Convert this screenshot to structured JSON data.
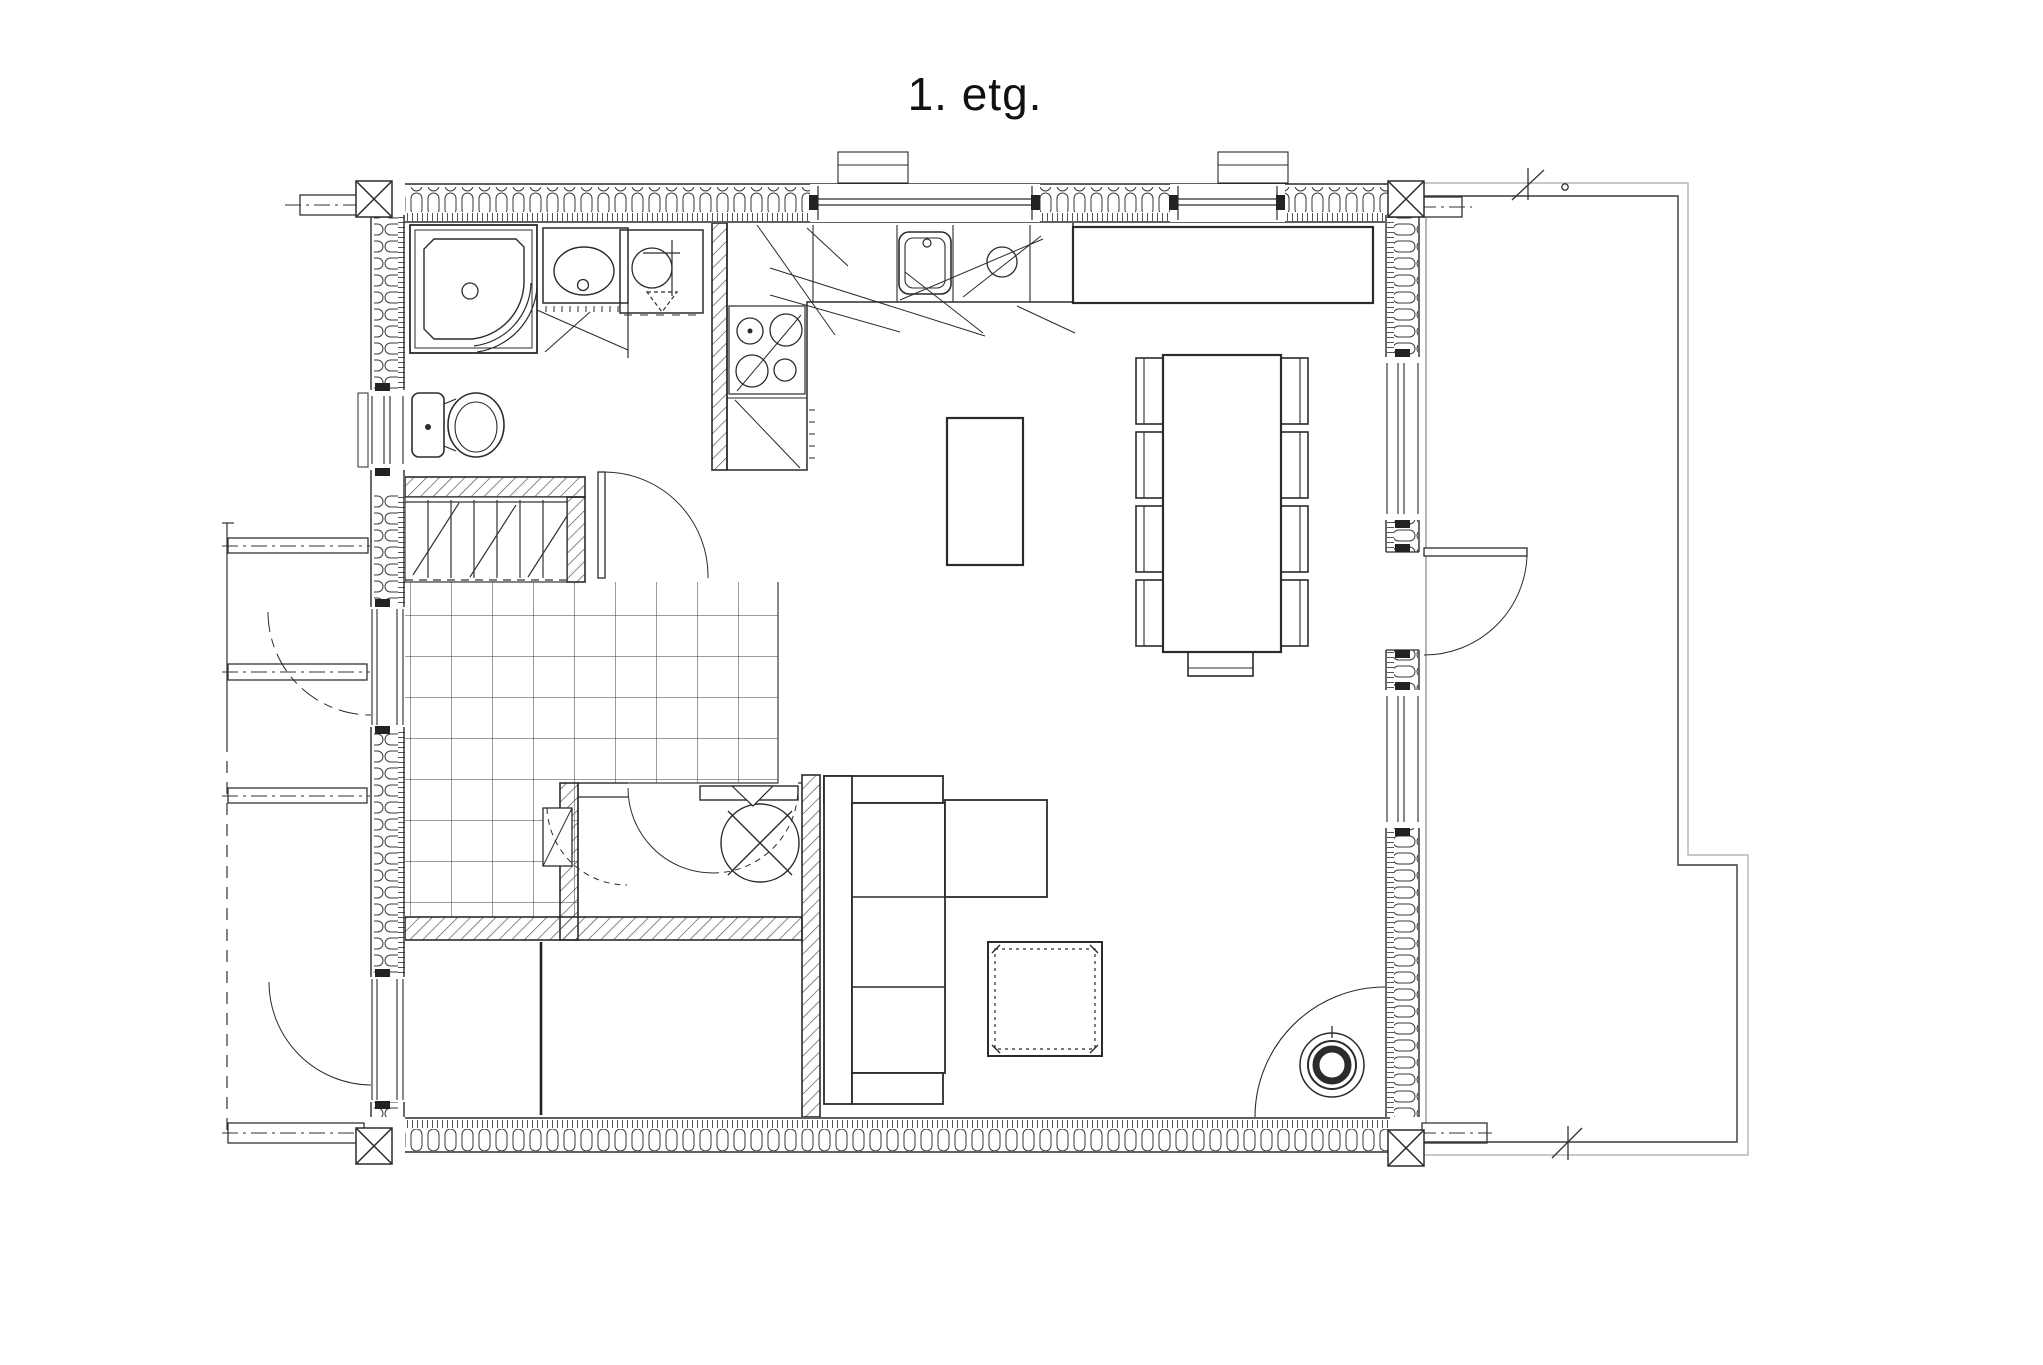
{
  "title": {
    "text": "1. etg."
  },
  "canvas": {
    "background": "#ffffff",
    "line_color": "#2b2b2b",
    "thin_line_color": "#9a9a9a",
    "hatch_color": "#444444"
  },
  "floorplan": {
    "floor_label": "1. etg.",
    "rooms_implied": [
      "bathroom",
      "stair-hall",
      "tiled-entry-hall",
      "closet-technical-room",
      "bedroom",
      "storage-room",
      "kitchen",
      "dining-area",
      "living-room",
      "terrace"
    ],
    "fixtures": [
      "corner-shower-cabin",
      "vanity-sink",
      "washing-machine",
      "floor-drain-arrow",
      "toilet",
      "staircase",
      "tile-floor-grid",
      "water-heater-symbol",
      "kitchen-counter",
      "kitchen-sink",
      "cooktop-4-burners",
      "dishwasher-symbol",
      "sideboard-bench",
      "kitchen-island-table",
      "dining-table",
      "dining-chairs",
      "corner-sofa",
      "rug",
      "wood-stove",
      "hearth-arc",
      "log-walls",
      "corner-posts",
      "interior-partition-walls",
      "entry-door",
      "bedroom-exterior-door",
      "bathroom-door",
      "terrace-door",
      "closet-door",
      "terrace-outline",
      "porch-beams",
      "module-center-lines",
      "survey-tick-marks"
    ],
    "counts": {
      "dining_chairs": 9,
      "cooktop_burners": 4,
      "stair_treads": 7
    }
  }
}
